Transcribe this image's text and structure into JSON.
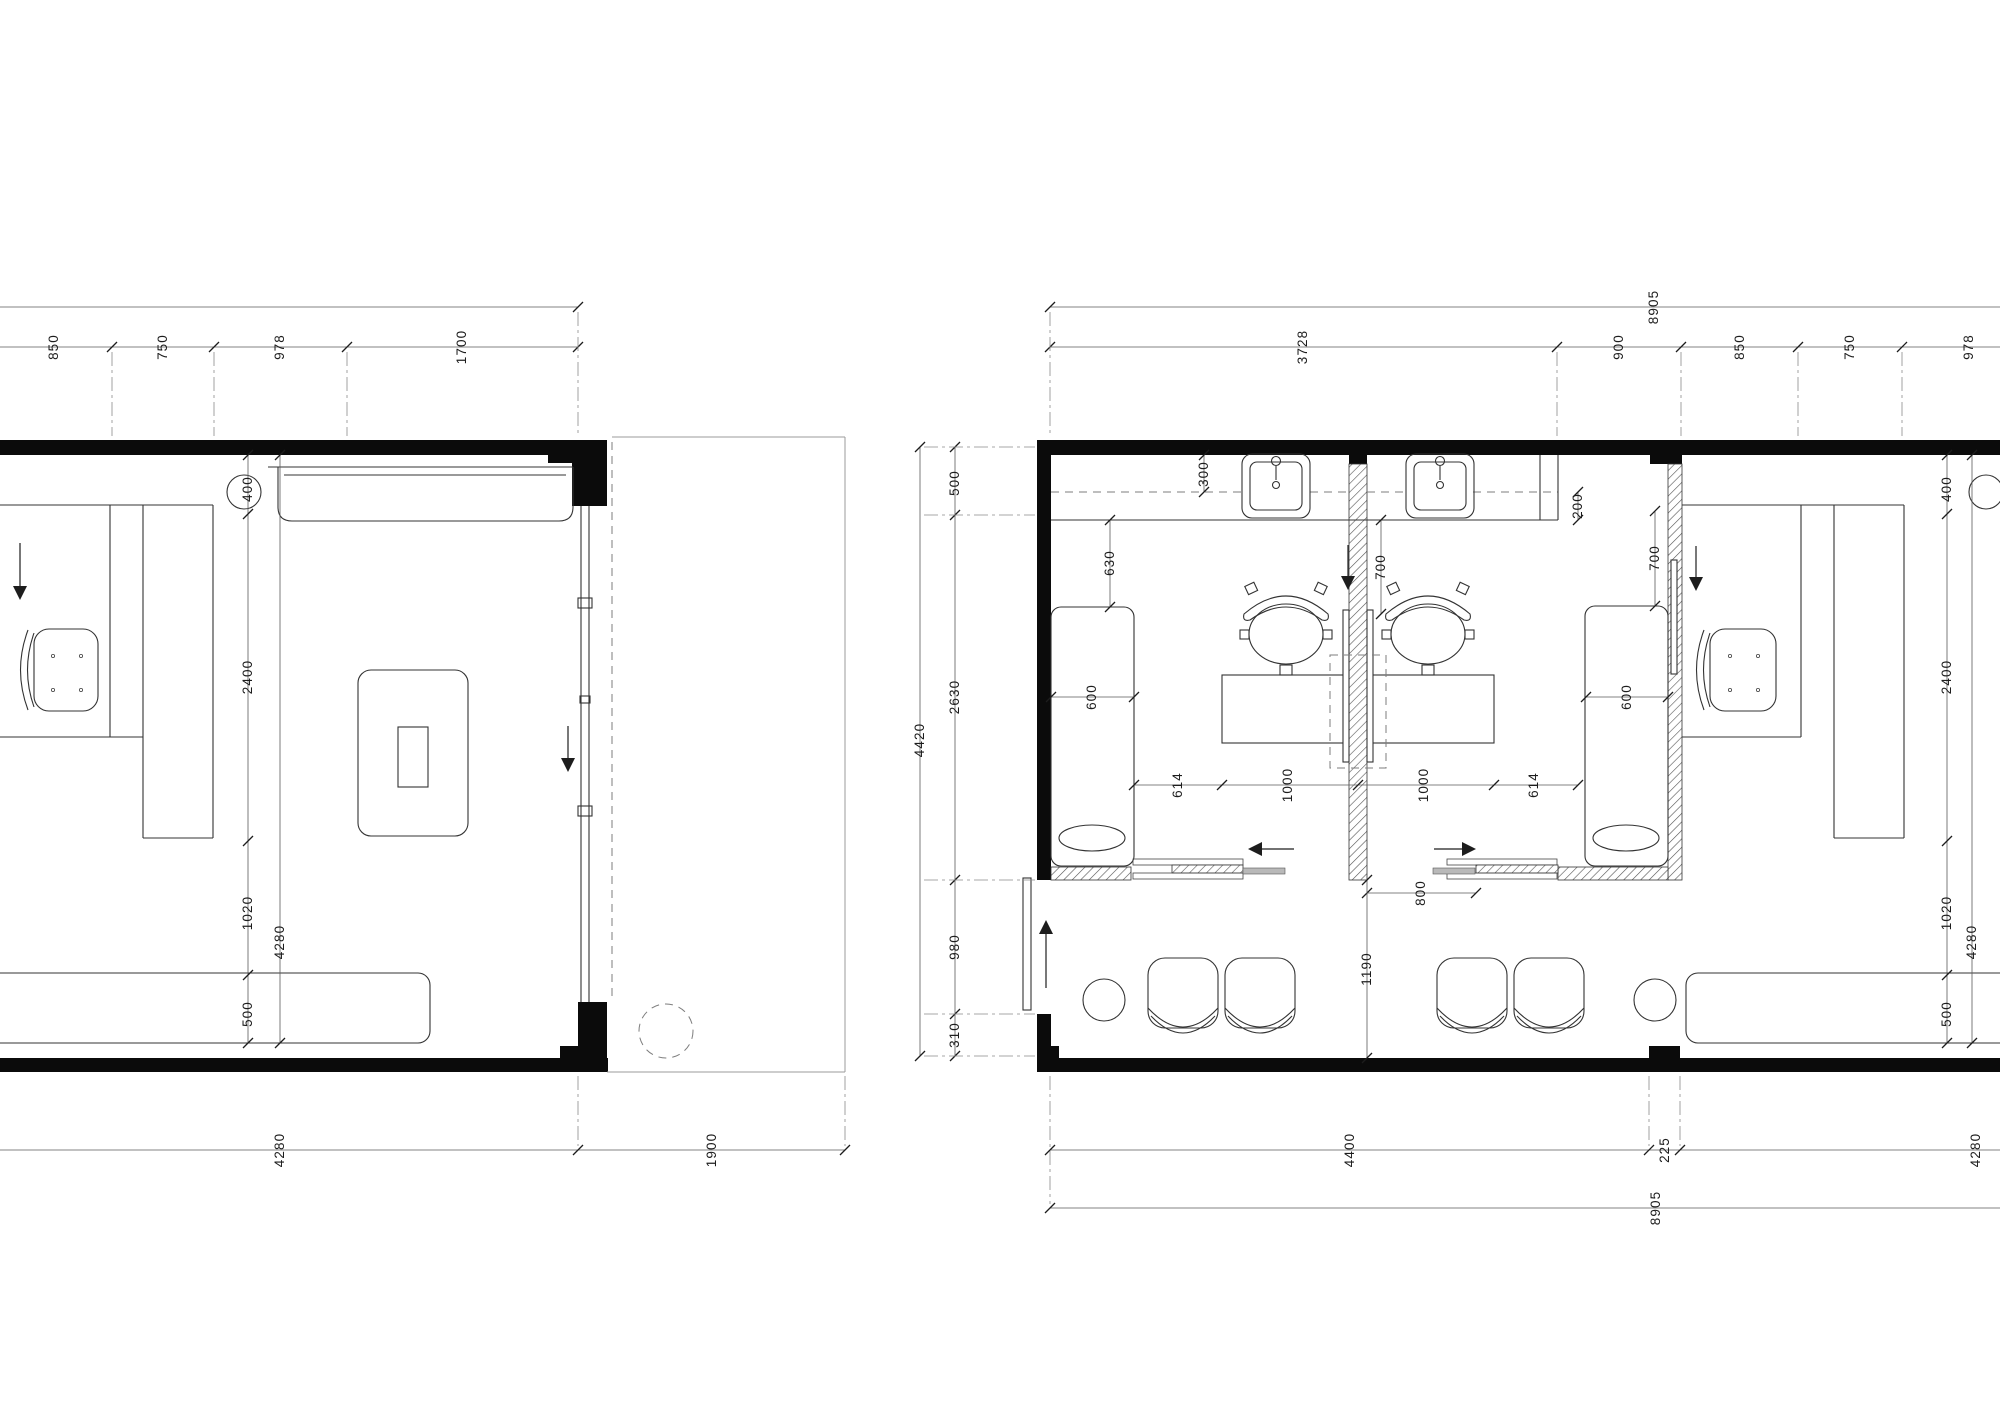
{
  "plan_left": {
    "top_dims": [
      "850",
      "750",
      "978",
      "1700"
    ],
    "side_dims": [
      "400",
      "2400",
      "1020",
      "500"
    ],
    "side_total": "4280",
    "bottom_dims": [
      "4280",
      "1900"
    ]
  },
  "plan_right": {
    "top_total": "8905",
    "top_dims": [
      "3728",
      "900",
      "850",
      "750",
      "978"
    ],
    "side_total": "4420",
    "side_dims": [
      "500",
      "2630",
      "980",
      "310"
    ],
    "interior": {
      "sink_offset": "300",
      "counter_depth": "200",
      "bench_left_offset": "630",
      "bench_left_width": "600",
      "bench_right_offset": "700",
      "bench_right_width": "600",
      "mirror_clearance": "700",
      "station_row": [
        "614",
        "1000",
        "1000",
        "614"
      ],
      "door_clearance": "800",
      "entry_zone": "1190"
    },
    "right_room_dims": [
      "400",
      "2400",
      "1020",
      "500"
    ],
    "right_room_total": "4280",
    "bottom_dims": [
      "4400",
      "225",
      "4280"
    ],
    "bottom_total": "8905"
  },
  "colors": {
    "wall": "#0b0b0b",
    "line": "#333333",
    "dimension": "#1d1d1d",
    "background": "#ffffff"
  }
}
